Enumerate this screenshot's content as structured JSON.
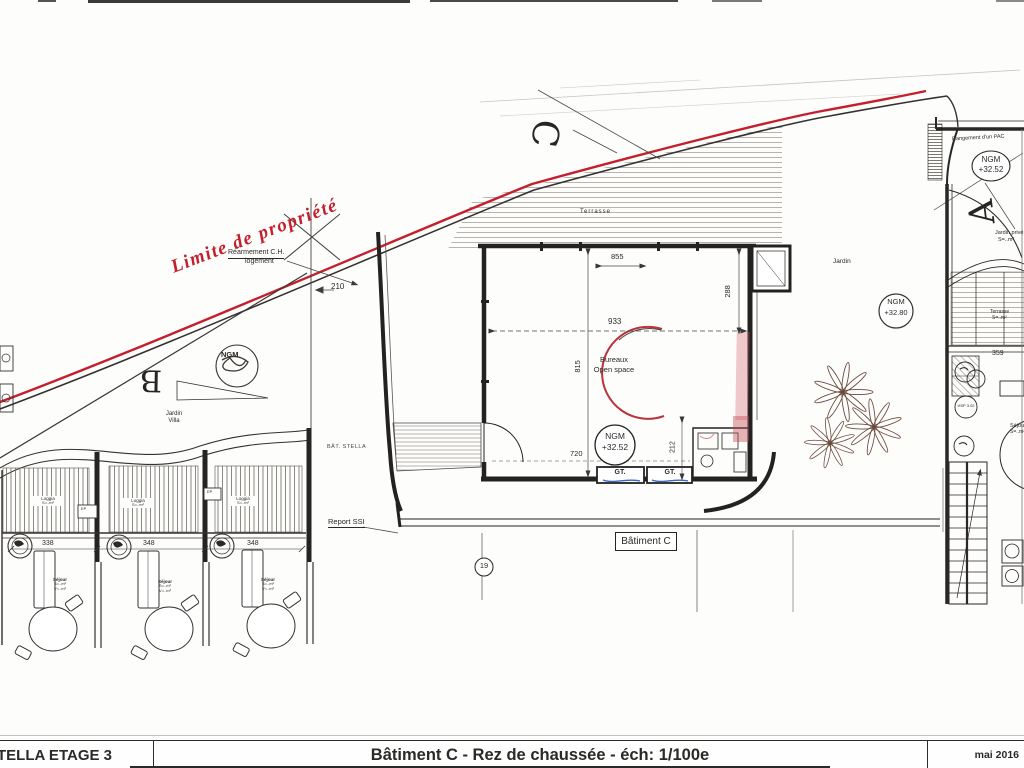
{
  "title_block": {
    "project": "TELLA ETAGE 3",
    "title": "Bâtiment C - Rez de chaussée - éch: 1/100e",
    "date": "mai 2016"
  },
  "section_letters": {
    "b": "B",
    "c": "C",
    "a": "A"
  },
  "labels": {
    "limite_propriete": "Limite de propriété",
    "rearmement_line1": "Réarmement C.H.",
    "rearmement_line2": "logement",
    "jardin_villa_line1": "Jardin",
    "jardin_villa_line2": "Villa",
    "terrasse": "Terrasse",
    "bureaux_line1": "Bureaux",
    "bureaux_line2": "Open space",
    "jardin": "Jardin",
    "rangement_pac": "Rangement d'un PAC",
    "jardin_prive_line1": "Jardin privé",
    "jardin_prive_line2": "S=..m²",
    "terrasse_a_line1": "Terrasse",
    "terrasse_a_line2": "S=..m²",
    "sejour_a_line1": "Séjour",
    "sejour_a_line2": "S=..m²",
    "hsp_marker": "HSP 3.02",
    "bat_annotation": "BÂT. STELLA",
    "report_ssi": "Report SSI",
    "batiment_c": "Bâtiment C",
    "loggia_line1": "Loggia",
    "loggia_line2": "S=..m²",
    "sejour_line1": "Séjour",
    "sejour_line2": "S=..m²",
    "sejour_line3": "V=..m³",
    "ep": "EP",
    "gt": "GT."
  },
  "levels": {
    "open_space": {
      "name": "NGM",
      "value": "+32.52"
    },
    "entry_top_right": {
      "name": "NGM",
      "value": "+32.52"
    },
    "jardin": {
      "name": "NGM",
      "value": "+32.80"
    },
    "villa_b": {
      "name": "NGM"
    }
  },
  "dimensions": {
    "d855": "855",
    "d933": "933",
    "d815": "815",
    "d288": "288",
    "d720": "720",
    "d212": "212",
    "d210": "210",
    "d338": "338",
    "d348a": "348",
    "d348b": "348",
    "d359": "359"
  },
  "markers": {
    "detail_ref": "19"
  },
  "colors": {
    "property_line": "#c41f2c",
    "annotation_blue": "#3a66c0",
    "ink": "#2b2a27"
  }
}
